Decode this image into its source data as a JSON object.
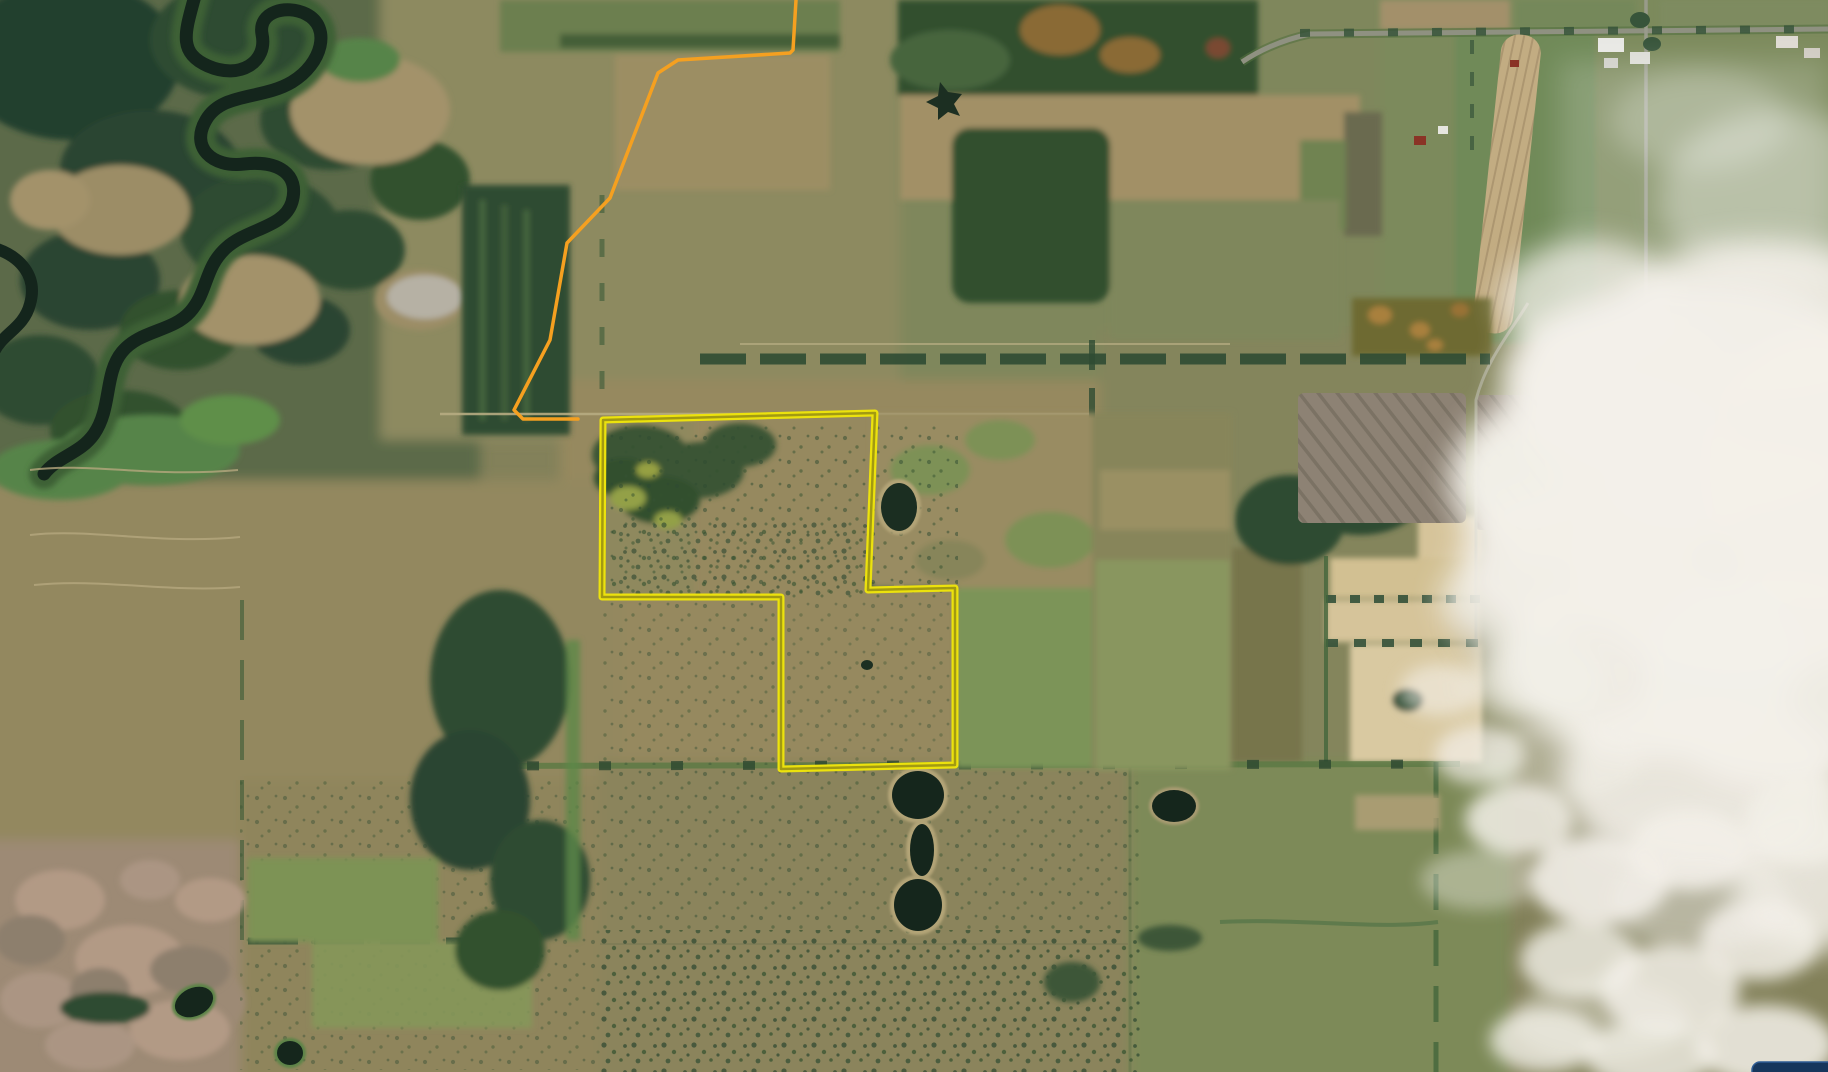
{
  "scene": {
    "kind": "aerial-satellite-map",
    "description": "Autumn farmland and marsh seen from above: winding dark river in the northwest, patchwork fields, scattered tree lines, ponds, and a white cumulus cloud bank covering the east side. A property parcel is outlined in yellow; an orange trail/boundary line runs to the northwest of it.",
    "palette": {
      "field_tan": "#9a8c63",
      "field_olive": "#7d8157",
      "pasture_green": "#7c9459",
      "forest_dark": "#2f4c33",
      "river_dark": "#14251c",
      "marsh_pink": "#a5907c",
      "cream_field": "#d8c79e",
      "cloud_white": "#f2efe8"
    }
  },
  "overlays": {
    "parcel_boundary": {
      "label": "parcel-boundary",
      "color": "#ece20d",
      "inner_color": "#a29a12",
      "stroke_width": 7,
      "inner_stroke_width": 2.5,
      "points": [
        [
          603,
          420
        ],
        [
          875,
          413
        ],
        [
          868,
          590
        ],
        [
          955,
          588
        ],
        [
          955,
          765
        ],
        [
          781,
          769
        ],
        [
          781,
          597
        ],
        [
          602,
          597
        ]
      ]
    },
    "trail": {
      "label": "trail-line",
      "color": "#f5a020",
      "stroke_width": 3.5,
      "points": [
        [
          796,
          0
        ],
        [
          793,
          50
        ],
        [
          790,
          53
        ],
        [
          678,
          60
        ],
        [
          658,
          73
        ],
        [
          610,
          198
        ],
        [
          567,
          243
        ],
        [
          550,
          340
        ],
        [
          514,
          410
        ],
        [
          523,
          419
        ],
        [
          578,
          419
        ]
      ]
    }
  },
  "ui": {
    "corner_panel": {
      "color": "#16365c",
      "border_color": "#2e5c94"
    }
  }
}
